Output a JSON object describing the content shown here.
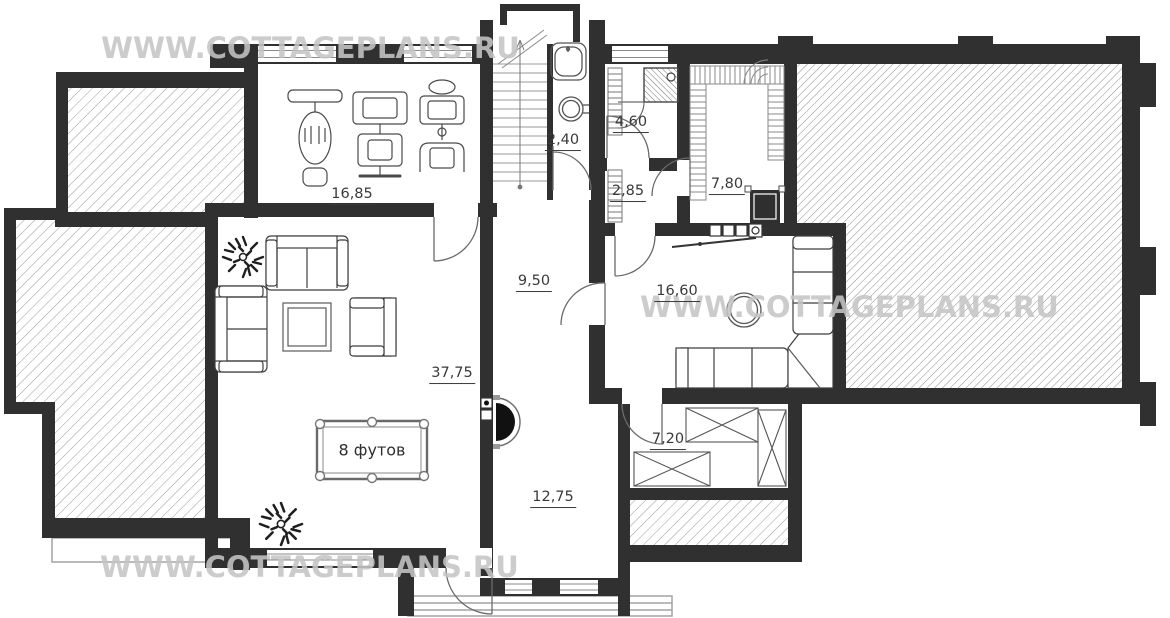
{
  "watermark": {
    "text": "WWW.COTTAGEPLANS.RU",
    "color": "#c5c5c5"
  },
  "rooms": {
    "gym": {
      "area": "16,85"
    },
    "bathroom": {
      "area": "2,40"
    },
    "shower_room": {
      "area": "4,60"
    },
    "wc": {
      "area": "2,85"
    },
    "sauna": {
      "area": "7,80"
    },
    "hall": {
      "area": "9,50"
    },
    "lounge": {
      "area": "16,60"
    },
    "living_room": {
      "area": "37,75"
    },
    "storage": {
      "area": "7,20"
    },
    "entrance_hall": {
      "area": "12,75"
    }
  },
  "billiard_table": {
    "label": "8 футов"
  },
  "colors": {
    "wall": "#303030",
    "hatch_line": "#979797",
    "label_text": "#3a3a3a"
  }
}
